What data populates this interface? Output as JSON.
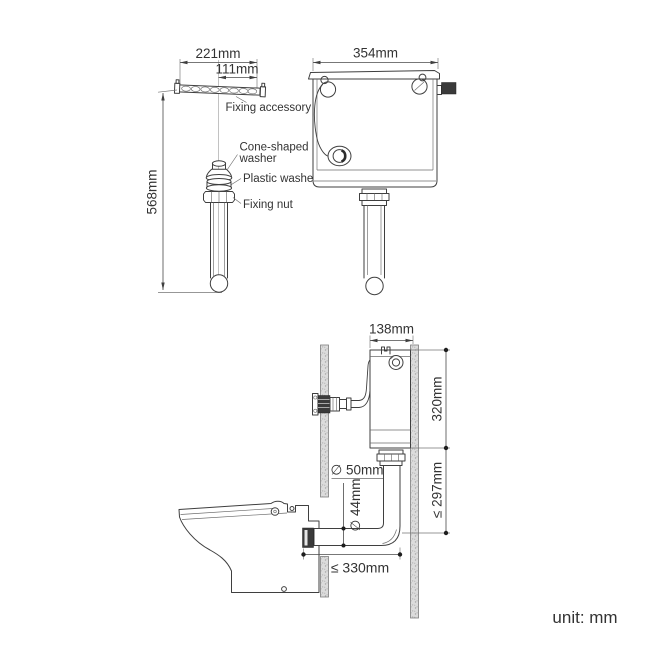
{
  "top_left_view": {
    "width_dim": "221mm",
    "hole_spacing_dim": "111mm",
    "height_dim": "568mm",
    "fixing_accessory_label": "Fixing accessory",
    "cone_washer_label_line1": "Cone-shaped",
    "cone_washer_label_line2": "washer",
    "plastic_washer_label": "Plastic washer",
    "fixing_nut_label": "Fixing nut"
  },
  "front_view": {
    "width_dim": "354mm"
  },
  "side_view": {
    "depth_dim": "138mm",
    "cistern_height_dim": "320mm",
    "flush_pipe_height_dim": "≤ 297mm",
    "flush_pipe_diameter_dim": "∅ 50mm",
    "outlet_pipe_diameter_dim": "∅ 44mm",
    "outlet_offset_dim": "≤ 330mm"
  },
  "footer": {
    "unit_label": "unit: mm"
  },
  "colors": {
    "line": "#3f3f3f",
    "text": "#333333",
    "wall_fill": "#dcdcdc",
    "background": "#ffffff"
  }
}
